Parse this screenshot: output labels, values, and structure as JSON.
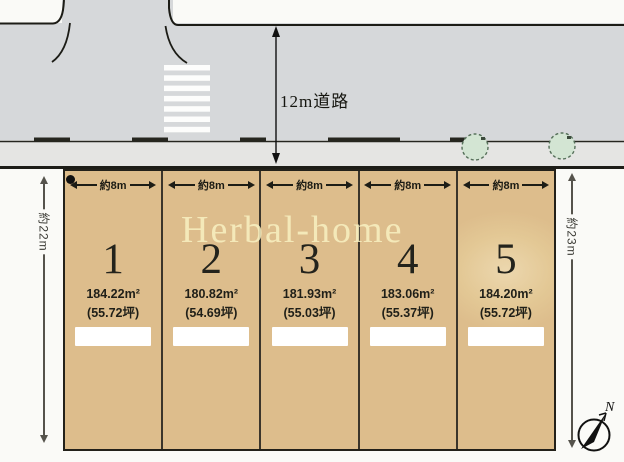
{
  "plan": {
    "watermark": "Herbal-home",
    "road_label": "12m道路",
    "dim_left": "約22m",
    "dim_right": "約23m",
    "lot_width_label": "約8m",
    "compass_label": "N"
  },
  "lots": [
    {
      "number": "1",
      "area": "184.22m²",
      "tsubo": "(55.72坪)"
    },
    {
      "number": "2",
      "area": "180.82m²",
      "tsubo": "(54.69坪)"
    },
    {
      "number": "3",
      "area": "181.93m²",
      "tsubo": "(55.03坪)"
    },
    {
      "number": "4",
      "area": "183.06m²",
      "tsubo": "(55.37坪)"
    },
    {
      "number": "5",
      "area": "184.20m²",
      "tsubo": "(55.72坪)"
    }
  ],
  "colors": {
    "lot_fill": "#ddbd8c",
    "road_fill": "#d6d8da",
    "sidewalk_fill": "#e5e5e3",
    "crosswalk": "#fdfdfc",
    "tree_fill": "#d3e5d3",
    "watermark_text": "#f9f1c2",
    "line": "#23211a",
    "price_box": "#ffffff"
  }
}
